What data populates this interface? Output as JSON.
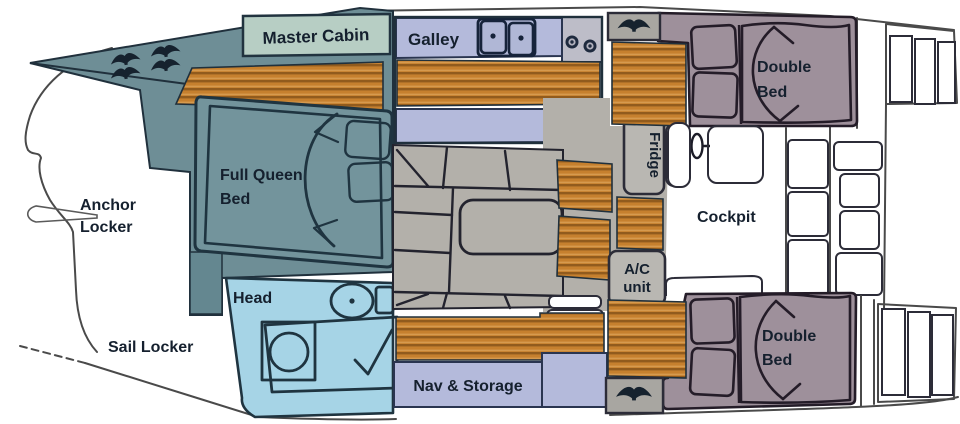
{
  "diagram": {
    "title": "Catamaran interior floor plan",
    "labels": {
      "master_cabin": "Master Cabin",
      "galley": "Galley",
      "fwd_cabin_line1": "Full Queen",
      "fwd_cabin_line2": "Bed",
      "anchor_locker_line1": "Anchor",
      "anchor_locker_line2": "Locker",
      "sail_locker": "Sail Locker",
      "head": "Head",
      "nav_storage": "Nav & Storage",
      "fridge": "Fridge",
      "ac_unit_line1": "A/C",
      "ac_unit_line2": "unit",
      "cockpit": "Cockpit",
      "aft_cabin_top_line1": "Double",
      "aft_cabin_top_line2": "Bed",
      "aft_cabin_bottom_line1": "Double",
      "aft_cabin_bottom_line2": "Bed"
    },
    "colors": {
      "deck_teal": "#6e8e96",
      "cabin_teal": "#73949c",
      "label_sage": "#b7cec4",
      "counter_lavender": "#b4badb",
      "floor_wood": "#c6802e",
      "floor_wood_dark": "#915b1d",
      "salon_gray": "#b3b0aa",
      "appliance_gray": "#b9b7b2",
      "bed_mauve": "#9e909b",
      "head_blue": "#a6d4e6",
      "outline_dark": "#20303c",
      "hull_line": "#4a4a4a",
      "text": "#15202e"
    },
    "icons": {
      "cleat": "deck-cleat",
      "sink": "double-sink",
      "stove": "two-burner-stove",
      "toilet": "toilet",
      "shower": "shower-basin",
      "winch": "winch"
    }
  }
}
